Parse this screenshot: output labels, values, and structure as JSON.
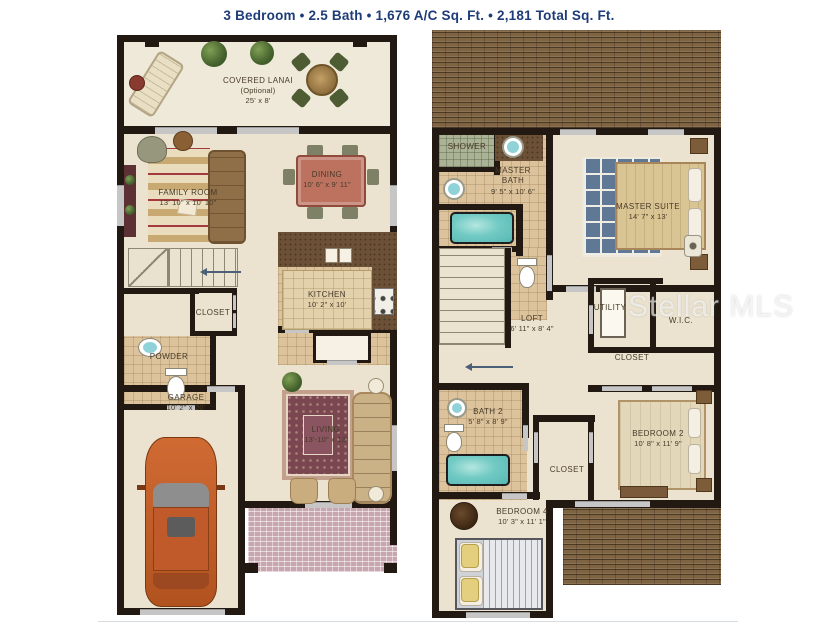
{
  "title": "3 Bedroom • 2.5 Bath • 1,676 A/C Sq. Ft. • 2,181 Total Sq. Ft.",
  "watermark": "Stellar MLS",
  "colors": {
    "title_navy": "#1e3c78",
    "wall_black": "#221a12",
    "floor_cream": "#ebe3cf",
    "bath_tile_tan": "#dcc39c",
    "roof_brown": "#7f6443",
    "water_teal": "#72cac4",
    "porch_brick_pink": "#c8a6b0",
    "rug_blue": "#5f7895",
    "rug_maroon": "#7a4750",
    "car_orange": "#bf5b2d"
  },
  "floor1": {
    "rooms": {
      "lanai": {
        "name": "COVERED LANAI",
        "note": "(Optional)",
        "dims": "25' x 8'"
      },
      "family": {
        "name": "FAMILY ROOM",
        "dims": "13' 10\" x 10' 10\""
      },
      "dining": {
        "name": "DINING",
        "dims": "10' 6\" x 9' 11\""
      },
      "kitchen": {
        "name": "KITCHEN",
        "dims": "10' 2\" x 10'"
      },
      "closet": {
        "name": "CLOSET"
      },
      "powder": {
        "name": "POWDER"
      },
      "garage": {
        "name": "GARAGE",
        "dims": "10' 2\" x 20'"
      },
      "living": {
        "name": "LIVING",
        "dims": "13'-10\" x 13'"
      }
    }
  },
  "floor2": {
    "rooms": {
      "shower": {
        "name": "SHOWER"
      },
      "master_bath": {
        "name": "MASTER BATH",
        "dims": "9' 5\" x 10' 6\""
      },
      "master_suite": {
        "name": "MASTER SUITE",
        "dims": "14' 7\" x 13'"
      },
      "loft": {
        "name": "LOFT",
        "dims": "6' 11\" x 8' 4\""
      },
      "utility": {
        "name": "UTILITY"
      },
      "wic": {
        "name": "W.I.C."
      },
      "closet_hall": {
        "name": "CLOSET"
      },
      "bath2": {
        "name": "BATH 2",
        "dims": "5' 8\" x 8' 9\""
      },
      "closet_bed": {
        "name": "CLOSET"
      },
      "bedroom2": {
        "name": "BEDROOM 2",
        "dims": "10' 8\" x 11' 9\""
      },
      "bedroom4": {
        "name": "BEDROOM 4",
        "dims": "10' 3\" x 11' 1\""
      }
    }
  }
}
